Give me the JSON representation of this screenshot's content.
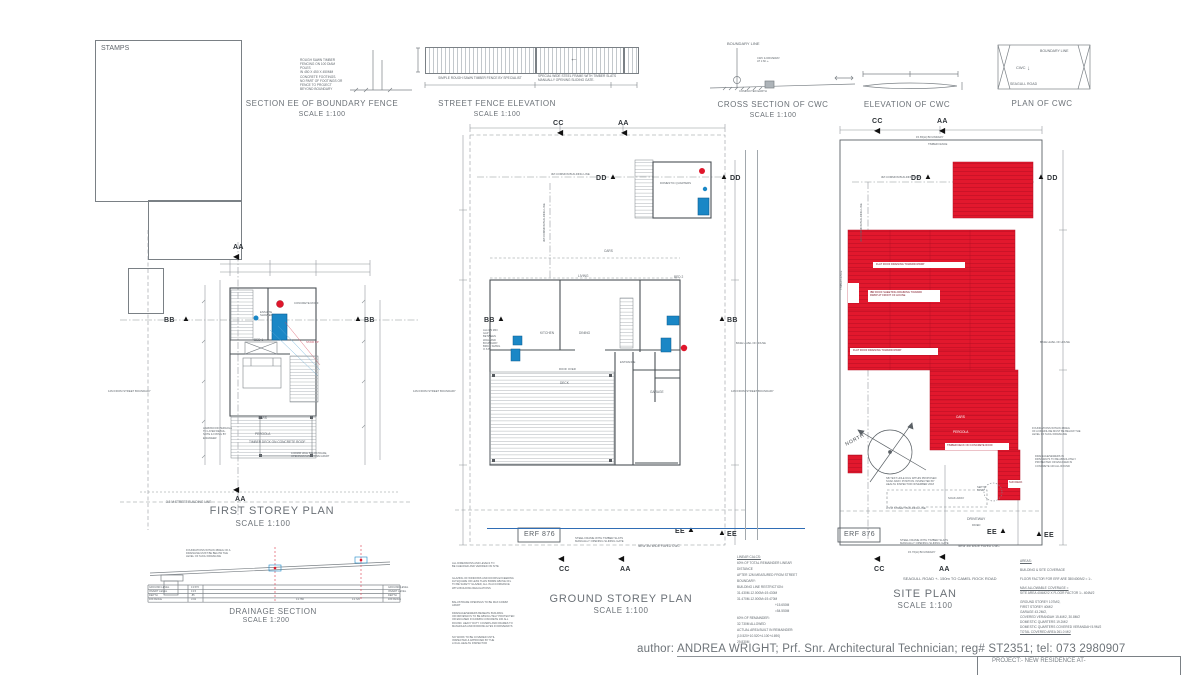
{
  "sheet": {
    "stamps_label": "STAMPS",
    "author_label": "author:",
    "author_value": "ANDREA WRIGHT; Prf. Snr. Architectural Technician; reg# ST2351; tel: 073 2980907",
    "project_line": "PROJECT:-  NEW RESIDENCE AT-"
  },
  "icons": {
    "triangle_up": "▲",
    "triangle_left": "◀",
    "arrow_left": "←",
    "arrow_down": "↓"
  },
  "colors": {
    "red_roof": "#e2182d",
    "fixture_blue": "#1a87c6",
    "line_blue": "#2f6db5",
    "drain_red": "#e05565"
  },
  "markers": {
    "aa": "AA",
    "bb": "BB",
    "cc": "CC",
    "dd": "DD",
    "ee": "EE"
  },
  "details": {
    "section_ee": {
      "title": "SECTION EE OF BOUNDARY FENCE",
      "scale": "SCALE 1:100",
      "note": "ROUGH SAWN TIMBER\nFENCING ON 100 DIAM POLES\nIN 450 X 450 X 450MM\nCONCRETE FOOTINGS.\nNO PART OF FOOTINGS OR\nFENCE TO PROJECT\nBEYOND BOUNDARY"
    },
    "street_fence": {
      "title": "STREET FENCE ELEVATION",
      "scale": "SCALE 1:100",
      "note_left": "SIMPLE ROUGH SAWN TIMBER FENCE BY SPECIALIST",
      "note_right": "SPECIAL WIDE STEEL FRAME WITH TIMBER SLATS\nMANUALLY OPENING SLIDING GATE."
    },
    "cross_cwc": {
      "title": "CROSS SECTION OF CWC",
      "scale": "SCALE 1:100",
      "boundary": "BOUNDARY LINE",
      "note": "CWC & DRIVEWAY\nAT 1:60 +-",
      "earth": "COMPACTED EARTH"
    },
    "elev_cwc": {
      "title": "ELEVATION OF CWC"
    },
    "plan_cwc": {
      "title": "PLAN OF CWC",
      "boundary": "BOUNDARY LINE",
      "cwc": "CWC",
      "road": "SEAGULL ROAD"
    }
  },
  "first_storey": {
    "title": "FIRST STOREY PLAN",
    "scale": "SCALE 1:100",
    "ensuite": "ENSUITE\nSHOWER",
    "bed": "BED 1",
    "concrete_roof": "CONCRETE ROOF",
    "stair": "STAIR UP",
    "cars": "CARS",
    "pergola": "PERGOLA",
    "deck": "TIMBER DECK ON CONCRETE ROOF",
    "balustrade": "1000MM HIGH BALUSTRADE,\nOPENINGS MAX 100MM APART",
    "pergola_note": "HARDWOOD PERGOLA\nTO LATER DETAIL.\nNOTE & FIXING BY\nENGINEER",
    "street_line": "3.5 M STREET BUILDING LINE",
    "boundary_note": "12M FROM STREET BOUNDARY"
  },
  "drainage": {
    "title": "DRAINAGE SECTION",
    "scale": "SCALE 1:200",
    "note": "FOUNDATIONS WITHIN 45DEG OF A\nDRAINLINE MUST BE BELOW THE\nLEVEL OF SUCH DRAINLINE",
    "rows": [
      "GROUND LEVEL",
      "INVERT LEVEL",
      "DEPTH",
      "DISTANCE"
    ],
    "values_left": [
      "13.570",
      "13.5",
      ".85",
      "3.02"
    ],
    "dist_left": "13.780",
    "dist_right": "13.720"
  },
  "ground_storey": {
    "title": "GROUND STOREY PLAN",
    "scale": "SCALE 1:100",
    "erf": "ERF 876",
    "domestic": "DOMESTIC QUARTERS",
    "living": "LIVING",
    "dining": "DINING",
    "kitchen": "KITCHEN",
    "bed2": "BED 2",
    "garage": "GARAGE",
    "entrance": "ENTRANCE",
    "deck": "DECK",
    "roof_over": "ROOF OVER",
    "cars": "CARS",
    "building_line": "3M COMMON BUILDING LINE",
    "allow_note": "ALLOW MIN\nGAP BETWEEN\nWALL AND\nBOUNDARY.\nBRICK SIZING\nO.S.B.",
    "gate_note": "STEEL FRAME WITH TIMBER SLATS\nMANUALLY OPENING SLIDING GATE",
    "cwc_note": "NEW 3M WIDE PAVED CWC",
    "base_note": "BASE LEVEL OF HOUSE",
    "boundary_note": "12M FROM STREET BOUNDARY"
  },
  "site_plan": {
    "title": "SITE PLAN",
    "scale": "SCALE 1:100",
    "erf": "ERF 876",
    "road_note": "SEAGULL ROAD  +-  150m  TO CAMEL ROCK ROAD",
    "boundary_top": "15.65(H) BOUNDARY",
    "boundary_bottom": "15.76(H) BOUNDARY",
    "timber_fence": "TIMBER FENCE",
    "building_line": "3M COMMON BUILDING LINE",
    "street_line": "3.5 M STREET BUILDING LINE",
    "north": "NORTH",
    "driveway": "DRIVEWAY",
    "paved": "PAVED",
    "septic": "SEPTIC\nTANK",
    "soak": "SOAK AWAY",
    "sun_deck": "SUN DECK",
    "cars": "CARS",
    "pergola": "PERGOLA",
    "deck": "TIMBER DECK ON CONCRETE ROOF",
    "roof1": "FLAT ROOF DRAINING TOWARD RWDP",
    "roof2": "IBR ROOF SHEETING DRAINING TOWARD\nRWDP AT FRONT OF HOUSE",
    "roof3": "FLAT ROOF DRAINING TOWARD RWDP",
    "test_note": "NB TEST HOLE DUG WITHIN PROPOSED\nSOAK AWAY POSITION. INSPECTED BY\nHEALTH INSPECTOR NOVEMBER 2018",
    "gate_note": "STEEL FRAME WITH TIMBER SLATS\nMANUALLY OPENING SLIDING GATE",
    "cwc_note": "NEW 3M WIDE PAVED CWC",
    "found_note": "FOUNDATIONS WITHIN 45DEG\nOF A DRAINLINE MUST BE BELOW THE\nLEVEL OF SUCH DRAINLINE",
    "drain_note": "DRAINAGE/SEWERS IN\nDRIVEWAYS TO BE ABSOLUTELY\nPROTECTED OR ENCASED IN\nCONCRETE 100 ALL ROUND",
    "base_note": "BASE LEVEL OF HOUSE",
    "boundary_note": "12M FROM STREET BOUNDARY"
  },
  "calcs": [
    "LINEAR CALCS:",
    "60% OF TOTAL REMAINDER LINEAR",
    "DISTANCE",
    "AFTER 12M MEASURED FROM STREET",
    "BOUNDARY:",
    "BUILDING LINE RESTRICTION:",
    "31.430M-12.000M=19.430M",
    "31.470M-12.000M=19.470M",
    "+15.650M",
    "=54.550M",
    "60% OF REMAINDER:",
    "32.730M ALLOWED",
    "ACTUAL AREA BUILT IN REMAINDER:",
    "(10.520+10.520+4.100+4.690)",
    "29.830M"
  ],
  "areas": [
    "AREAS:",
    "BUILDING & SITE COVERAGE",
    "FLOOR FACTOR FOR ERF ARE 350/400/M2 = 1:-",
    "MAX ALLOWABLE COVERAGE =",
    "SITE AREA 404M2/2 X FLOOR FACTOR 1:- 404M/2",
    "GROUND STOREY 107M/2,",
    "FIRST STOREY 40M/2",
    "GARAGE 43.2M/2,",
    "COVERED VERANDAH 15.4M/2, 30.8M/2",
    "DOMESTIC QUARTERS 19.2M/2",
    "DOMESTIC QUARTERS COVERED VERANDAH 5.9M/2",
    "TOTAL COVERED AREA        261.0 M/2"
  ],
  "notes": [
    "ALL DIMENSIONS AND LEVELS TO\nBE CHECKED AND VERIFIED ON SITE",
    "GLAZING OF WINDOWS AND DOORS EXCEEDING\n1M SQUARE OR LESS THAN 500MM ABOVE FFL\nTO BE SAFETY GLAZED, ALL IN ACCORDANCE\nWITH BUILDING REGULATIONS",
    "BALUSTRADE OPENINGS TO BE MAX 100MM\nAPART",
    "DRAINAGE/SEWERS BENEATH BUILDING\nOR DRIVEWAYS TO BE ABSOLUTELY PROTECTED\nOR ENCASED IN 100MPA CONCRETE 100 ALL\nROUND. HEAVY DUTY COVERS AND FRAMES TO\nMANHOLES AND RODDING EYES IN DRIVEWAYS",
    "NO WORK TO BE COVERED UNTIL\nINSPECTED & APPROVED BY THE\nLOCAL HEALTH INSPECTOR"
  ]
}
